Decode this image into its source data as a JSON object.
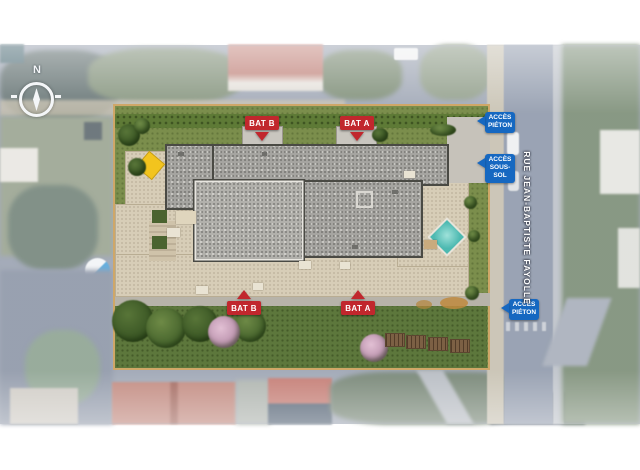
{
  "plan": {
    "compass_north": "N",
    "street_name": "RUE JEAN-BAPTISTE FAYOLLE"
  },
  "markers": {
    "bat_top": [
      {
        "label": "BAT B"
      },
      {
        "label": "BAT A"
      }
    ],
    "bat_bottom": [
      {
        "label": "BAT B"
      },
      {
        "label": "BAT A"
      }
    ],
    "access": [
      {
        "line1": "ACCÈS",
        "line2": "PIÉTON"
      },
      {
        "line1": "ACCÈS",
        "line2": "SOUS-SOL"
      },
      {
        "line1": "ACCÈS",
        "line2": "PIÉTON"
      }
    ]
  },
  "legend_colors": {
    "building_marker_red": "#c1272d",
    "access_marker_blue": "#1668c1",
    "roof_gravel_gray": "#a6a5a1",
    "lawn_green": "#7b8e4c",
    "terrace_beige": "#d7cdb7",
    "pool_teal": "#4db9b1",
    "street_gray": "#8f99ab"
  }
}
